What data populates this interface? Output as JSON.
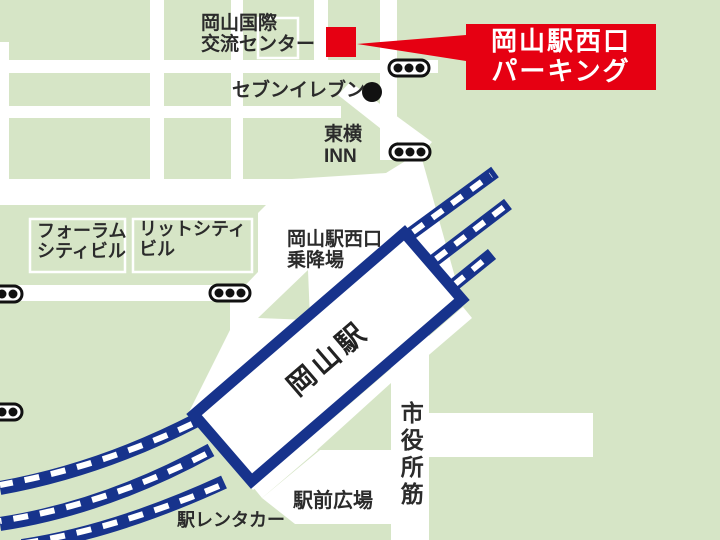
{
  "map": {
    "colors": {
      "background_green": "#d6e5c6",
      "road_white": "#ffffff",
      "railway_navy": "#17338c",
      "callout_red": "#e60012",
      "text_dark": "#2b2b2b",
      "traffic_light_black": "#111111"
    },
    "callout": {
      "line1": "岡山駅西口",
      "line2": "パーキング"
    },
    "labels": {
      "kokusai": {
        "line1": "岡山国際",
        "line2": "交流センター"
      },
      "seven_eleven": {
        "text": "セブンイレブン"
      },
      "toyoko": {
        "line1": "東横",
        "line2": "INN"
      },
      "forum": {
        "line1": "フォーラム",
        "line2": "シティビル"
      },
      "lit_city": {
        "line1": "リットシティ",
        "line2": "ビル"
      },
      "boarding": {
        "line1": "岡山駅西口",
        "line2": "乗降場"
      },
      "station": {
        "text": "岡山駅"
      },
      "shiyakusho": {
        "text": "市役所筋"
      },
      "ekimae_plaza": {
        "text": "駅前広場"
      },
      "rentacar": {
        "text": "駅レンタカー"
      }
    },
    "icons": {
      "traffic_light_count": "5",
      "poi_dot": "seven-eleven-location"
    }
  }
}
